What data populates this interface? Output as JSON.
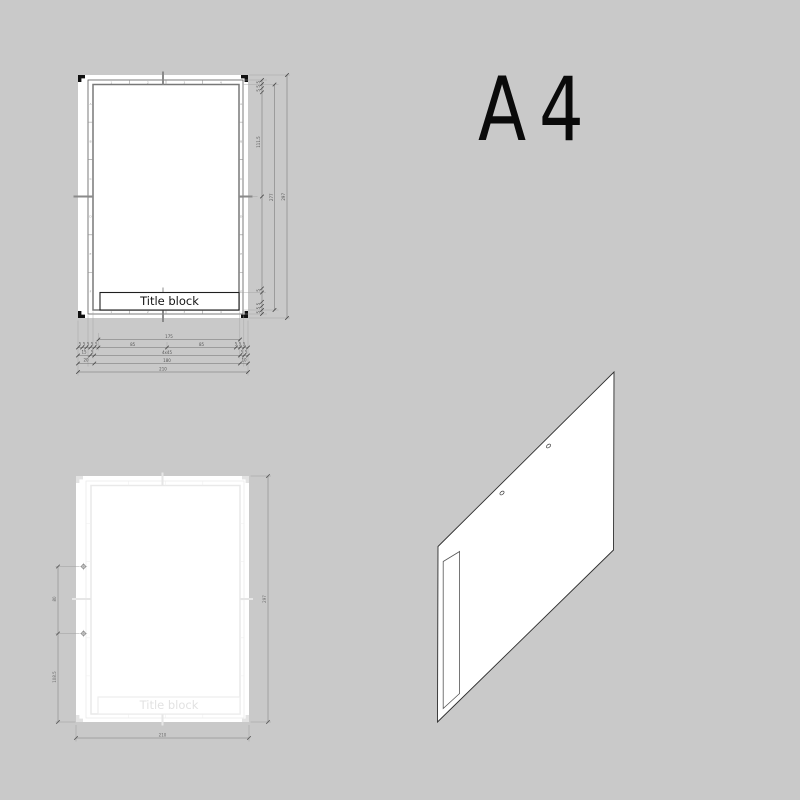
{
  "page": {
    "background_color": "#c9c9c9"
  },
  "heading": {
    "label": "A4"
  },
  "colors": {
    "background": "#c9c9c9",
    "ink": "#1a1a1a",
    "dimension_lines": "#555555",
    "ghost_lines": "#ececec"
  },
  "front_view": {
    "title_block": {
      "label": "Title block"
    },
    "grid": {
      "column_labels": [
        "1",
        "2",
        "3",
        "4"
      ],
      "row_labels": [
        "A",
        "B",
        "C",
        "D",
        "E",
        "F"
      ]
    },
    "dims": {
      "tick5": "5",
      "right_upper": "111.5",
      "frame_height": "277",
      "sheet_height": "297",
      "span175": "175",
      "half85": "85",
      "left15": "15",
      "divisions": "4x45",
      "left20": "20",
      "frame_width": "180",
      "right10": "10",
      "sheet_width": "210"
    }
  },
  "ghost_view": {
    "title_block": {
      "label": "Title block"
    },
    "dims": {
      "hole_spacing": "80",
      "hole_to_bottom": "108.5",
      "sheet_height": "297",
      "sheet_width": "210"
    }
  }
}
